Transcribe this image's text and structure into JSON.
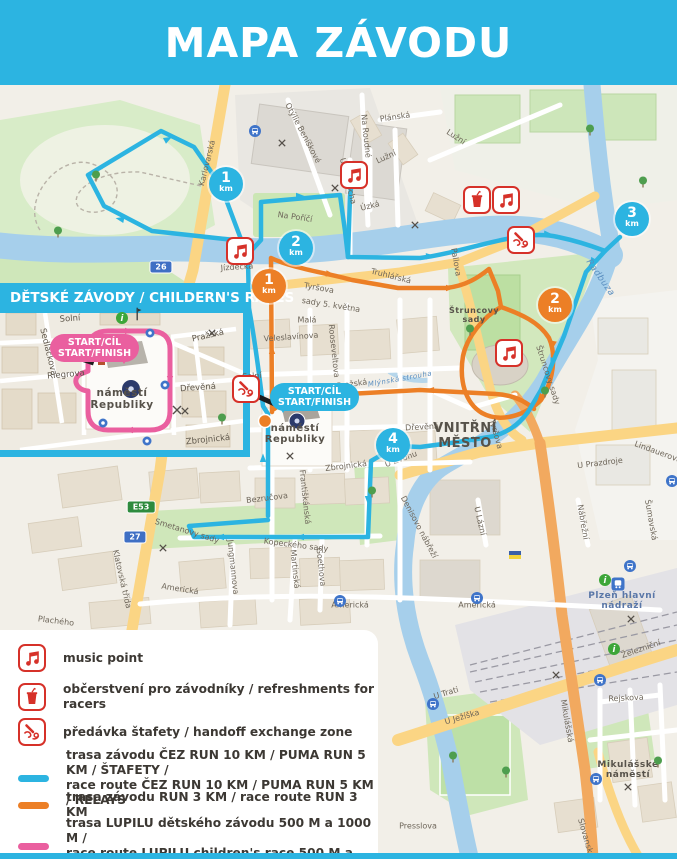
{
  "header": {
    "title": "MAPA ZÁVODU"
  },
  "colors": {
    "cyan": "#2cb4e1",
    "orange": "#ec7f26",
    "pink": "#ea5f9f",
    "red": "#d63129"
  },
  "start_bubble": {
    "line1": "START/CÍL",
    "line2": "START/FINISH"
  },
  "inset": {
    "title": "DĚTSKÉ ZÁVODY / CHILDERN'S RACES",
    "start_line1": "START/CÍL",
    "start_line2": "START/FINISH"
  },
  "legend": {
    "rows": [
      {
        "icon": "music",
        "label": "music point"
      },
      {
        "icon": "refreshment",
        "label": "občerstvení pro závodníky / refreshments for racers"
      },
      {
        "icon": "handoff",
        "label": "předávka štafety / handoff exchange zone"
      },
      {
        "swatch": "cyan",
        "label": "trasa závodu ČEZ RUN 10 KM / PUMA RUN 5 KM / ŠTAFETY /",
        "label2": "race route ČEZ RUN 10 KM / PUMA RUN 5 KM / RELAYS"
      },
      {
        "swatch": "orange",
        "label": "trasa závodu RUN 3 KM / race route RUN 3 KM"
      },
      {
        "swatch": "pink",
        "label": "trasa LUPILU dětského závodu 500 M a 1000 M /",
        "label2": "race route LUPILU children's race 500 M a 1000 M"
      }
    ]
  },
  "map": {
    "km_badges": [
      {
        "value": "1",
        "unit": "km",
        "color": "cyan",
        "x": 226,
        "y": 184
      },
      {
        "value": "2",
        "unit": "km",
        "color": "cyan",
        "x": 296,
        "y": 248
      },
      {
        "value": "3",
        "unit": "km",
        "color": "cyan",
        "x": 632,
        "y": 219
      },
      {
        "value": "4",
        "unit": "km",
        "color": "cyan",
        "x": 393,
        "y": 445
      },
      {
        "value": "1",
        "unit": "km",
        "color": "orange",
        "x": 269,
        "y": 286
      },
      {
        "value": "2",
        "unit": "km",
        "color": "orange",
        "x": 555,
        "y": 305
      }
    ],
    "poi_icons": [
      {
        "type": "music",
        "x": 354,
        "y": 175
      },
      {
        "type": "music",
        "x": 240,
        "y": 251
      },
      {
        "type": "music",
        "x": 506,
        "y": 200
      },
      {
        "type": "music",
        "x": 509,
        "y": 353
      },
      {
        "type": "refreshment",
        "x": 477,
        "y": 200
      },
      {
        "type": "handoff",
        "x": 521,
        "y": 240
      },
      {
        "type": "handoff",
        "x": 246,
        "y": 389
      }
    ],
    "shields": [
      {
        "text": "26",
        "style": "blue",
        "x": 161,
        "y": 267
      },
      {
        "text": "27",
        "style": "blue",
        "x": 135,
        "y": 537
      },
      {
        "text": "E53",
        "style": "green",
        "x": 141,
        "y": 507
      }
    ],
    "area_labels": [
      {
        "lines": [
          "VNITŘNÍ",
          "MĚSTO"
        ],
        "x": 465,
        "y": 436,
        "size": 13
      },
      {
        "lines": [
          "náměstí",
          "Republiky"
        ],
        "x": 295,
        "y": 434,
        "size": 10
      },
      {
        "lines": [
          "náměstí",
          "Republiky"
        ],
        "x": 122,
        "y": 399,
        "size": 10.5
      },
      {
        "lines": [
          "Štruncovy",
          "sady"
        ],
        "x": 474,
        "y": 315,
        "size": 8
      },
      {
        "lines": [
          "Plzeň hlavní",
          "nádraží"
        ],
        "x": 622,
        "y": 601,
        "size": 9,
        "color": "#5a77a8"
      },
      {
        "lines": [
          "Mikulášské",
          "náměstí"
        ],
        "x": 628,
        "y": 770,
        "size": 9
      },
      {
        "lines": [
          "Radbuza"
        ],
        "x": 600,
        "y": 278,
        "size": 9,
        "rot": 55,
        "water": true
      },
      {
        "lines": [
          "Mlýnská strouha"
        ],
        "x": 400,
        "y": 379,
        "size": 7,
        "rot": -10,
        "water": true
      }
    ],
    "street_labels": [
      [
        "Karlovarská",
        207,
        163,
        -76
      ],
      [
        "Otýlie Beníškové",
        303,
        133,
        62
      ],
      [
        "Plánská",
        395,
        117,
        -8
      ],
      [
        "Na Roudné",
        366,
        136,
        84
      ],
      [
        "Lužní",
        456,
        137,
        33
      ],
      [
        "Lužní",
        386,
        157,
        -25
      ],
      [
        "Úzká",
        370,
        206,
        -14
      ],
      [
        "U Sv. Rocha",
        348,
        181,
        76
      ],
      [
        "Na Poříčí",
        295,
        217,
        8
      ],
      [
        "Jízdecká",
        237,
        267,
        -4
      ],
      [
        "Pallova",
        456,
        262,
        80
      ],
      [
        "Truhlářská",
        391,
        276,
        14
      ],
      [
        "Tyršova",
        319,
        288,
        10
      ],
      [
        "sady 5. května",
        331,
        305,
        9
      ],
      [
        "Malá",
        307,
        320,
        0
      ],
      [
        "Veleslavínova",
        291,
        337,
        -4
      ],
      [
        "Rooseveltova",
        334,
        351,
        84
      ],
      [
        "Solní",
        252,
        376,
        -4
      ],
      [
        "Pražská",
        352,
        384,
        -8
      ],
      [
        "Dřevěná",
        422,
        427,
        -3
      ],
      [
        "U Zvonu",
        401,
        459,
        -20
      ],
      [
        "Zbrojnická",
        346,
        466,
        -7
      ],
      [
        "Bezručova",
        267,
        498,
        -7
      ],
      [
        "Františkánská",
        305,
        497,
        84
      ],
      [
        "Smetanovy sady",
        187,
        531,
        17
      ],
      [
        "Kopeckého sady",
        296,
        545,
        7
      ],
      [
        "Klatovská třída",
        122,
        579,
        77
      ],
      [
        "Jungmannova",
        233,
        567,
        84
      ],
      [
        "Martinská",
        295,
        569,
        84
      ],
      [
        "Goethova",
        321,
        567,
        84
      ],
      [
        "Americká",
        180,
        589,
        9
      ],
      [
        "Americká",
        350,
        605,
        0
      ],
      [
        "Americká",
        477,
        605,
        0
      ],
      [
        "Plachého",
        56,
        621,
        7
      ],
      [
        "Denisovo nábřeží",
        419,
        527,
        62
      ],
      [
        "U Lázní",
        480,
        521,
        77
      ],
      [
        "Nábřežní",
        583,
        522,
        80
      ],
      [
        "U Prazdroje",
        600,
        463,
        -7
      ],
      [
        "Šumavská",
        651,
        520,
        80
      ],
      [
        "Lindauerova",
        658,
        452,
        20
      ],
      [
        "Rejskova",
        626,
        698,
        -3
      ],
      [
        "U Trati",
        446,
        693,
        -17
      ],
      [
        "U Ježíška",
        462,
        717,
        -16
      ],
      [
        "Mikulášská",
        567,
        721,
        80
      ],
      [
        "Železniční",
        641,
        649,
        -19
      ],
      [
        "Presslova",
        418,
        826,
        0
      ],
      [
        "Slovanská",
        586,
        838,
        74
      ],
      [
        "Tyršova",
        496,
        434,
        74
      ],
      [
        "Štruncovy sady",
        548,
        375,
        72
      ]
    ],
    "inset_street_labels": [
      [
        "Solní",
        70,
        319,
        -4
      ],
      [
        "Sedláčkova",
        48,
        352,
        76
      ],
      [
        "Pražská",
        208,
        336,
        -13
      ],
      [
        "Riegrova",
        66,
        375,
        -5
      ],
      [
        "Dřevěná",
        198,
        388,
        -4
      ],
      [
        "Zbrojnická",
        208,
        440,
        -6
      ]
    ],
    "decorations": {
      "bus": [
        [
          255,
          131
        ],
        [
          340,
          601
        ],
        [
          477,
          598
        ],
        [
          630,
          566
        ],
        [
          600,
          680
        ],
        [
          433,
          704
        ],
        [
          672,
          481
        ],
        [
          596,
          779
        ]
      ],
      "train": [
        [
          618,
          584
        ]
      ],
      "tree": [
        [
          96,
          176
        ],
        [
          58,
          232
        ],
        [
          590,
          130
        ],
        [
          643,
          182
        ],
        [
          470,
          330
        ],
        [
          545,
          392
        ],
        [
          372,
          492
        ],
        [
          453,
          757
        ],
        [
          506,
          772
        ],
        [
          658,
          762
        ]
      ],
      "cross": [
        [
          282,
          143
        ],
        [
          335,
          188
        ],
        [
          415,
          225
        ],
        [
          290,
          456
        ],
        [
          163,
          548
        ],
        [
          631,
          619
        ],
        [
          628,
          787
        ],
        [
          556,
          675
        ]
      ],
      "info": [
        [
          605,
          580
        ],
        [
          614,
          649
        ]
      ],
      "flag": [
        [
          515,
          555
        ]
      ],
      "stop": [
        [
          165,
          385
        ],
        [
          103,
          423
        ],
        [
          147,
          441
        ],
        [
          150,
          333
        ]
      ],
      "darkflag": [
        [
          137,
          314
        ]
      ],
      "inset_info": [
        [
          122,
          318
        ]
      ],
      "inset_cross": [
        [
          185,
          411
        ],
        [
          212,
          333
        ]
      ],
      "inset_tree": [
        [
          222,
          419
        ]
      ]
    }
  }
}
